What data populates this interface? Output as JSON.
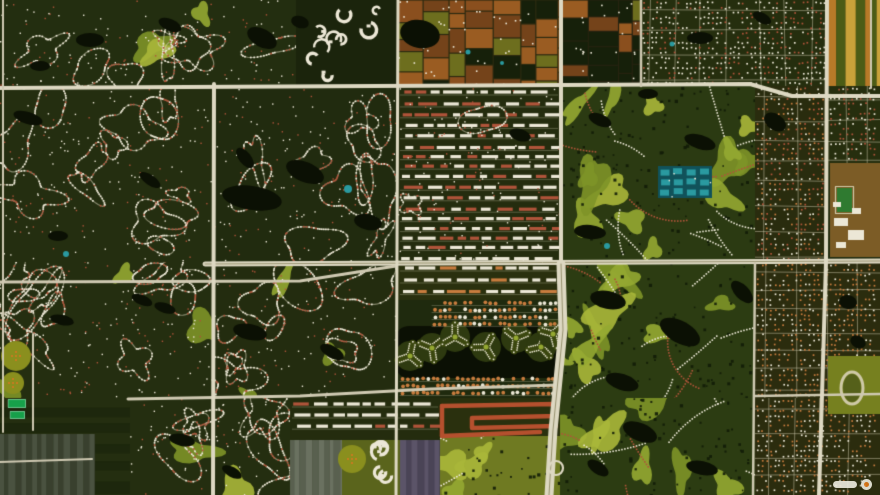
{
  "scene": {
    "width": 880,
    "height": 495,
    "palette": {
      "baseDark": "#1f2a0e",
      "veg": "#26330f",
      "vegDark": "#16200a",
      "road": "#cfc9b2",
      "roadMajor": "#ddd8c2",
      "median": "#97926f",
      "water": "#0b1004",
      "pool": "#2a9aa0",
      "houseWhite": "#ece7d6",
      "houseRed": "#b0543a",
      "houseOrange": "#c87c3e",
      "golf1": "#7e9428",
      "golf2": "#95a832",
      "golf3": "#aab73a",
      "farmBrown1": "#8a4f1e",
      "farmBrown2": "#9a5c22",
      "farmBrown3": "#74431a",
      "farmOlive": "#6d6e1e",
      "stripOrange": "#b87a28",
      "stripYellow": "#c9a23a",
      "stripGreen": "#4c5c16",
      "ghGray": "#59604f",
      "ghGray2": "#6a7160",
      "ghPurple": "#5b5468",
      "ghPurple2": "#4a4456",
      "tan": "#7c5c26",
      "field": "#2f7a30",
      "trackOlive": "#76801f",
      "track": "#cfc9a8",
      "emerald": "#17a04a",
      "orchard": "#8a8f1e",
      "orchardDot": "#c97a20",
      "red": "#b5502e",
      "island": "#2e3a10",
      "armGreen": "#3b470f",
      "tealBase": "#11525a"
    },
    "blocks": [
      {
        "x": 0,
        "y": 0,
        "w": 296,
        "h": 86,
        "base": "#232e10",
        "tex": "curvy",
        "seed": 11,
        "loops": 8,
        "golf": 3
      },
      {
        "x": 296,
        "y": 0,
        "w": 102,
        "h": 86,
        "base": "#1b240c",
        "tex": "clusters",
        "seed": 21,
        "n": 9
      },
      {
        "x": 398,
        "y": 0,
        "w": 162,
        "h": 86,
        "base": "#2c2a10",
        "tex": "farm",
        "seed": 31,
        "dark": 0.25
      },
      {
        "x": 560,
        "y": 0,
        "w": 81,
        "h": 86,
        "base": "#262310",
        "tex": "farm",
        "seed": 41,
        "dark": 0.5
      },
      {
        "x": 641,
        "y": 0,
        "w": 187,
        "h": 86,
        "base": "#252e0e",
        "tex": "grid",
        "seed": 51,
        "colors": [
          "houseWhite",
          "houseWhite",
          "houseRed"
        ]
      },
      {
        "x": 828,
        "y": 0,
        "w": 52,
        "h": 86,
        "base": "#3a3c10",
        "tex": "stripsV",
        "seed": 61,
        "colors": [
          "stripOrange",
          "stripGreen",
          "stripYellow",
          "stripGreen"
        ],
        "minW": 5,
        "maxW": 11
      },
      {
        "x": 0,
        "y": 86,
        "w": 213,
        "h": 176,
        "base": "#242e10",
        "tex": "curvy",
        "seed": 71,
        "loops": 13
      },
      {
        "x": 213,
        "y": 86,
        "w": 185,
        "h": 176,
        "base": "#212b0f",
        "tex": "curvy",
        "seed": 81,
        "loops": 11
      },
      {
        "x": 398,
        "y": 86,
        "w": 162,
        "h": 176,
        "base": "#242c0e",
        "tex": "rowsMix",
        "seed": 91,
        "colors": [
          "houseWhite",
          "houseWhite",
          "houseRed"
        ]
      },
      {
        "x": 560,
        "y": 86,
        "w": 195,
        "h": 176,
        "base": "#2b3a12",
        "tex": "golf",
        "seed": 101
      },
      {
        "x": 755,
        "y": 86,
        "w": 73,
        "h": 176,
        "base": "#292c0e",
        "tex": "grid",
        "seed": 105,
        "colors": [
          "houseWhite",
          "houseOrange",
          "houseRed"
        ]
      },
      {
        "x": 828,
        "y": 86,
        "w": 52,
        "h": 79,
        "base": "#262e0e",
        "tex": "grid",
        "seed": 111,
        "colors": [
          "houseWhite",
          "houseRed"
        ]
      },
      {
        "x": 0,
        "y": 262,
        "w": 213,
        "h": 136,
        "base": "#242e10",
        "tex": "curvy",
        "seed": 121,
        "loops": 13,
        "golf": 3
      },
      {
        "x": 213,
        "y": 262,
        "w": 185,
        "h": 136,
        "base": "#232c0f",
        "tex": "curvy",
        "seed": 131,
        "loops": 10,
        "golf": 3
      },
      {
        "x": 398,
        "y": 262,
        "w": 162,
        "h": 38,
        "base": "#2a300e",
        "tex": "rows",
        "seed": 141,
        "colors": [
          "houseWhite",
          "houseWhite",
          "houseOrange"
        ]
      },
      {
        "x": 560,
        "y": 262,
        "w": 195,
        "h": 136,
        "base": "#2c3c12",
        "tex": "golf",
        "seed": 151
      },
      {
        "x": 755,
        "y": 262,
        "w": 125,
        "h": 136,
        "base": "#2b2c0e",
        "tex": "grid",
        "seed": 161,
        "colors": [
          "houseOrange",
          "houseWhite",
          "houseOrange"
        ]
      },
      {
        "x": 0,
        "y": 398,
        "w": 130,
        "h": 97,
        "base": "#1d270d",
        "tex": "stripsH",
        "seed": 171,
        "colors": [
          "#242e10",
          "#1d270d"
        ],
        "minW": 6,
        "maxW": 12
      },
      {
        "x": 0,
        "y": 434,
        "w": 95,
        "h": 61,
        "base": "#39402e",
        "tex": "stripsV",
        "seed": 172,
        "colors": [
          "#4a5240",
          "#39402e"
        ],
        "minW": 4,
        "maxW": 8
      },
      {
        "x": 130,
        "y": 398,
        "w": 160,
        "h": 97,
        "base": "#242e10",
        "tex": "curvy",
        "seed": 181,
        "loops": 9,
        "golf": 2
      },
      {
        "x": 290,
        "y": 398,
        "w": 150,
        "h": 42,
        "base": "#242c0e",
        "tex": "rows",
        "seed": 191,
        "colors": [
          "houseWhite",
          "houseRed",
          "houseWhite"
        ]
      },
      {
        "x": 290,
        "y": 440,
        "w": 52,
        "h": 55,
        "base": "#3b4233",
        "tex": "stripsV",
        "seed": 192,
        "colors": [
          "ghGray",
          "ghGray2"
        ],
        "minW": 4,
        "maxW": 7
      },
      {
        "x": 342,
        "y": 440,
        "w": 58,
        "h": 55,
        "base": "#5a641c",
        "tex": "clusters",
        "seed": 193,
        "n": 5
      },
      {
        "x": 400,
        "y": 440,
        "w": 45,
        "h": 55,
        "base": "#4a4456",
        "tex": "stripsV",
        "seed": 194,
        "colors": [
          "ghPurple",
          "ghPurple2"
        ],
        "minW": 4,
        "maxW": 7
      },
      {
        "x": 440,
        "y": 398,
        "w": 120,
        "h": 40,
        "base": "#2a300e",
        "tex": "none",
        "seed": 201
      },
      {
        "x": 440,
        "y": 436,
        "w": 120,
        "h": 59,
        "base": "#6f7a22",
        "tex": "golf",
        "seed": 202
      },
      {
        "x": 560,
        "y": 398,
        "w": 195,
        "h": 97,
        "base": "#2c3c12",
        "tex": "golf",
        "seed": 211
      },
      {
        "x": 755,
        "y": 398,
        "w": 125,
        "h": 97,
        "base": "#2b2c0e",
        "tex": "grid",
        "seed": 221,
        "colors": [
          "houseOrange",
          "houseWhite"
        ]
      }
    ],
    "lakes": [
      [
        90,
        40,
        14,
        7,
        0
      ],
      [
        170,
        25,
        12,
        6,
        0.4
      ],
      [
        40,
        66,
        10,
        5,
        0
      ],
      [
        262,
        38,
        16,
        9,
        0.5
      ],
      [
        300,
        22,
        9,
        6,
        0.3
      ],
      [
        420,
        34,
        20,
        14,
        0.2
      ],
      [
        700,
        38,
        13,
        6,
        0
      ],
      [
        762,
        18,
        10,
        5,
        0.5
      ],
      [
        28,
        118,
        15,
        6,
        0.3
      ],
      [
        58,
        236,
        10,
        5,
        0
      ],
      [
        150,
        180,
        12,
        5,
        0.6
      ],
      [
        252,
        198,
        30,
        12,
        0.15
      ],
      [
        305,
        172,
        20,
        10,
        0.4
      ],
      [
        368,
        222,
        14,
        8,
        0.2
      ],
      [
        245,
        158,
        12,
        6,
        0.9
      ],
      [
        600,
        120,
        12,
        6,
        0.4
      ],
      [
        648,
        94,
        10,
        5,
        0
      ],
      [
        700,
        142,
        16,
        7,
        0.3
      ],
      [
        775,
        122,
        12,
        8,
        0.6
      ],
      [
        590,
        232,
        16,
        7,
        0.1
      ],
      [
        608,
        300,
        18,
        9,
        0.2
      ],
      [
        680,
        332,
        22,
        11,
        0.5
      ],
      [
        742,
        292,
        14,
        7,
        0.8
      ],
      [
        622,
        382,
        17,
        8,
        0.3
      ],
      [
        640,
        432,
        18,
        9,
        0.4
      ],
      [
        702,
        468,
        16,
        7,
        0.2
      ],
      [
        598,
        468,
        12,
        6,
        0.6
      ],
      [
        250,
        332,
        17,
        8,
        0.2
      ],
      [
        332,
        352,
        13,
        6,
        0.5
      ],
      [
        165,
        308,
        11,
        5,
        0.3
      ],
      [
        182,
        440,
        13,
        6,
        0.2
      ],
      [
        232,
        472,
        11,
        5,
        0.5
      ],
      [
        848,
        302,
        9,
        7,
        0.2
      ],
      [
        858,
        342,
        8,
        6,
        0.5
      ],
      [
        62,
        320,
        12,
        5,
        0.2
      ],
      [
        142,
        300,
        11,
        5,
        0.4
      ],
      [
        520,
        135,
        11,
        6,
        0.3
      ]
    ],
    "roads": [
      {
        "pts": [
          [
            0,
            88
          ],
          [
            750,
            84
          ],
          [
            792,
            96
          ],
          [
            880,
            96
          ]
        ],
        "w": 4,
        "major": true
      },
      {
        "pts": [
          [
            205,
            264
          ],
          [
            880,
            261
          ]
        ],
        "w": 5,
        "major": true,
        "median": true
      },
      {
        "pts": [
          [
            0,
            282
          ],
          [
            300,
            281
          ],
          [
            396,
            266
          ]
        ],
        "w": 3
      },
      {
        "pts": [
          [
            128,
            399
          ],
          [
            300,
            396
          ],
          [
            430,
            389
          ],
          [
            558,
            385
          ]
        ],
        "w": 3
      },
      {
        "pts": [
          [
            755,
            396
          ],
          [
            880,
            394
          ]
        ],
        "w": 2.5
      },
      {
        "pts": [
          [
            3,
            0
          ],
          [
            3,
            432
          ]
        ],
        "w": 2
      },
      {
        "pts": [
          [
            214,
            84
          ],
          [
            213,
            495
          ]
        ],
        "w": 4,
        "major": true
      },
      {
        "pts": [
          [
            398,
            0
          ],
          [
            396,
            495
          ]
        ],
        "w": 3,
        "major": true
      },
      {
        "pts": [
          [
            561,
            0
          ],
          [
            561,
            264
          ]
        ],
        "w": 4,
        "major": true
      },
      {
        "pts": [
          [
            561,
            264
          ],
          [
            563,
            330
          ],
          [
            553,
            430
          ],
          [
            549,
            495
          ]
        ],
        "w": 9,
        "major": true,
        "median": true
      },
      {
        "pts": [
          [
            641,
            0
          ],
          [
            641,
            86
          ]
        ],
        "w": 2.5
      },
      {
        "pts": [
          [
            827,
            0
          ],
          [
            826,
            262
          ],
          [
            819,
            495
          ]
        ],
        "w": 4,
        "major": true
      },
      {
        "pts": [
          [
            871,
            0
          ],
          [
            871,
            88
          ]
        ],
        "w": 2
      },
      {
        "pts": [
          [
            33,
            334
          ],
          [
            33,
            430
          ]
        ],
        "w": 2
      },
      {
        "pts": [
          [
            755,
            263
          ],
          [
            753,
            495
          ]
        ],
        "w": 2.5
      },
      {
        "pts": [
          [
            0,
            462
          ],
          [
            92,
            459
          ]
        ],
        "w": 2
      }
    ],
    "features": {
      "trilobes": {
        "lake": [
          396,
          326,
          166,
          52
        ],
        "centers": [
          [
            410,
            356,
            0.2
          ],
          [
            432,
            348,
            0.9
          ],
          [
            455,
            337,
            0
          ],
          [
            486,
            347,
            0.5
          ],
          [
            516,
            338,
            1.2
          ],
          [
            541,
            347,
            0.3
          ],
          [
            553,
            334,
            0.8
          ]
        ]
      },
      "orangeRows": [
        [
          432,
          300,
          126,
          30
        ],
        [
          400,
          376,
          158,
          22
        ]
      ],
      "redSnakes": [
        [
          [
            442,
            406
          ],
          [
            556,
            404
          ],
          [
            556,
            416
          ],
          [
            472,
            418
          ],
          [
            472,
            428
          ],
          [
            556,
            426
          ]
        ],
        [
          [
            442,
            436
          ],
          [
            540,
            432
          ]
        ],
        [
          [
            442,
            406
          ],
          [
            442,
            436
          ]
        ]
      ],
      "tealComplex": [
        658,
        166,
        54,
        32
      ],
      "school": {
        "rect": [
          830,
          163,
          50,
          94
        ],
        "bldgs": [
          [
            834,
            218,
            14,
            8
          ],
          [
            848,
            230,
            16,
            10
          ],
          [
            836,
            242,
            10,
            6
          ],
          [
            852,
            208,
            9,
            6
          ],
          [
            833,
            202,
            8,
            5
          ]
        ],
        "field": [
          837,
          188,
          15,
          24
        ]
      },
      "trackPark": {
        "rect": [
          828,
          356,
          52,
          58
        ],
        "ellipse": [
          852,
          388,
          11,
          16
        ]
      },
      "orchards": [
        [
          16,
          356,
          15
        ],
        [
          13,
          383,
          11
        ],
        [
          352,
          459,
          14
        ]
      ],
      "courts": [
        [
          8,
          399,
          18,
          9
        ],
        [
          10,
          411,
          15,
          8
        ]
      ],
      "pools": [
        [
          66,
          254,
          3
        ],
        [
          348,
          189,
          4
        ],
        [
          468,
          52,
          2.5
        ],
        [
          502,
          63,
          2
        ],
        [
          607,
          246,
          3
        ],
        [
          672,
          44,
          2.5
        ]
      ],
      "interchange": [
        556,
        468,
        7
      ]
    },
    "watermark": {
      "shapes": [
        "logo-pill",
        "globe-mark"
      ]
    }
  }
}
